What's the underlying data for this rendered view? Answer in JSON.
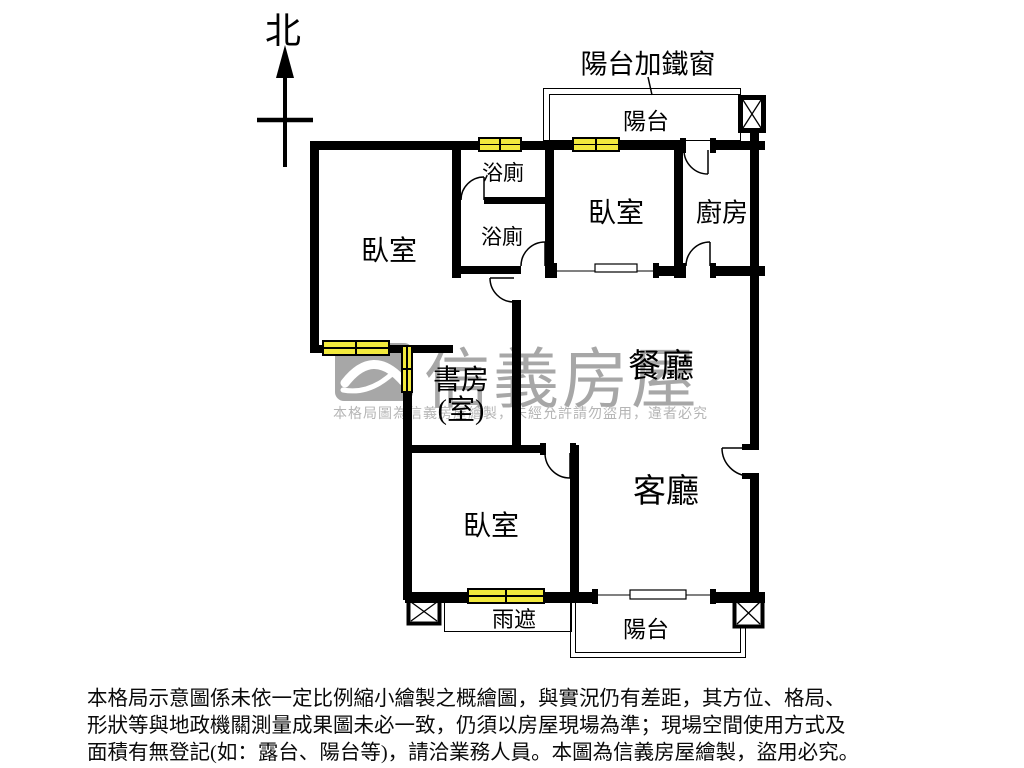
{
  "meta": {
    "title_hint": "apartment floor plan",
    "canvas_width": 1024,
    "canvas_height": 768
  },
  "compass": {
    "label": "北"
  },
  "annotations": {
    "balcony_note": "陽台加鐵窗"
  },
  "rooms": {
    "balcony_top": "陽台",
    "bathroom_1": "浴廁",
    "bathroom_2": "浴廁",
    "bedroom_left": "臥室",
    "bedroom_top": "臥室",
    "kitchen": "廚房",
    "dining": "餐廳",
    "study_line1": "書房",
    "study_line2": "(室)",
    "living": "客廳",
    "bedroom_bottom": "臥室",
    "rain_shade": "雨遮",
    "balcony_bottom": "陽台"
  },
  "watermark": {
    "brand": "信義房屋",
    "notice": "本格局圖為信義房屋繪製，未經允許請勿盜用，違者必究"
  },
  "disclaimer": {
    "line1": "本格局示意圖係未依一定比例縮小繪製之概繪圖，與實況仍有差距，其方位、格局、",
    "line2": "形狀等與地政機關測量成果圖未必一致，仍須以房屋現場為準；現場空間使用方式及",
    "line3": "面積有無登記(如：露台、陽台等)，請洽業務人員。本圖為信義房屋繪製，盜用必究。"
  },
  "colors": {
    "wall": "#000000",
    "window_fill": "#f2e93d",
    "watermark_gray": "#a7a7a7",
    "watermark_text_gray": "#b5b5b5",
    "text": "#000000",
    "background": "#ffffff"
  }
}
